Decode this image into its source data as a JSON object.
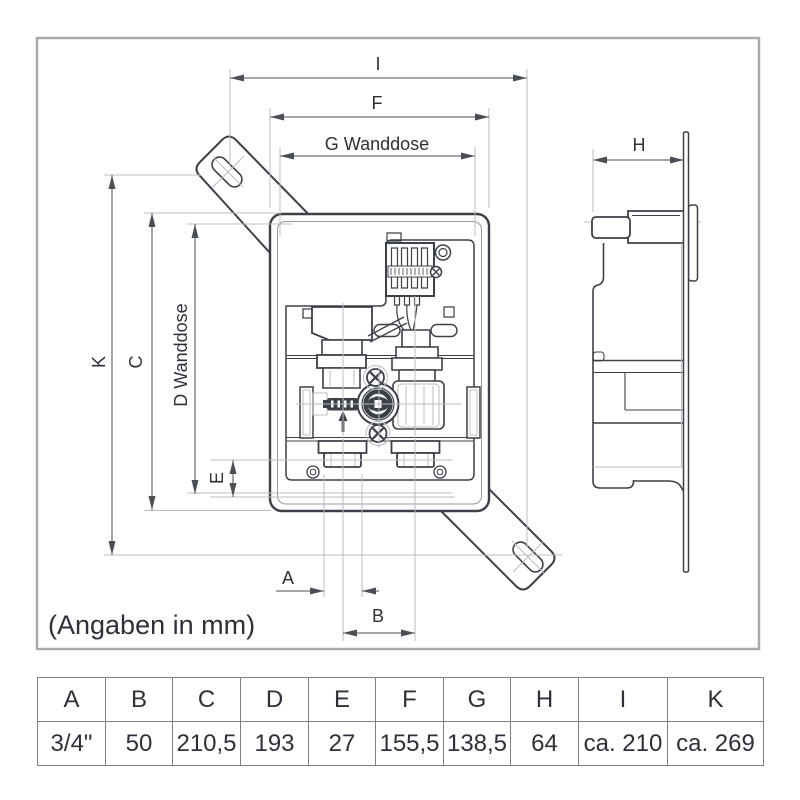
{
  "title": "Wanddose Montage-Zeichnung",
  "note": "(Angaben in mm)",
  "colors": {
    "line": "#3c4047",
    "thin": "#b9bcc2",
    "dim": "#4a4e55",
    "text": "#2d3138",
    "frame": "#a9abae",
    "tableline": "#7d8187"
  },
  "dim_labels": {
    "I": "I",
    "F": "F",
    "G": "G Wanddose",
    "K": "K",
    "C": "C",
    "D": "D Wanddose",
    "E": "E",
    "A": "A",
    "B": "B",
    "H": "H"
  },
  "table": {
    "headers": [
      "A",
      "B",
      "C",
      "D",
      "E",
      "F",
      "G",
      "H",
      "I",
      "K"
    ],
    "values": [
      "3/4\"",
      "50",
      "210,5",
      "193",
      "27",
      "155,5",
      "138,5",
      "64",
      "ca. 210",
      "ca. 269"
    ]
  }
}
